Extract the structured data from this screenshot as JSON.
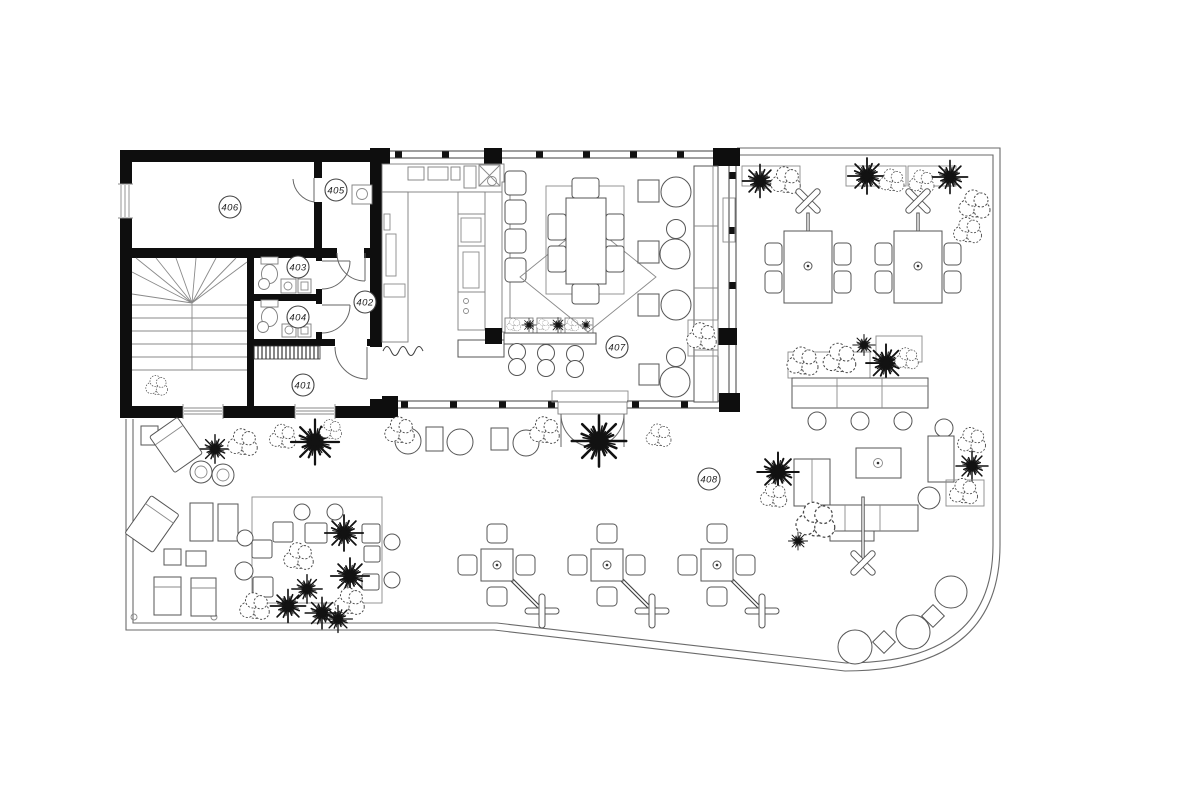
{
  "plan": {
    "type": "architectural floor plan with terrace",
    "colors": {
      "background": "#ffffff",
      "walls": "#0e0e0e",
      "lines": "#3f3f3f"
    },
    "rooms": [
      {
        "number": "401"
      },
      {
        "number": "402"
      },
      {
        "number": "403"
      },
      {
        "number": "404"
      },
      {
        "number": "405"
      },
      {
        "number": "406"
      },
      {
        "number": "407"
      },
      {
        "number": "408"
      }
    ],
    "icons": {
      "umbrella-x": "crossed bars",
      "cantilever-umbrella": "plus bars with diagonal pole",
      "plant-bush": "scribbled round bush",
      "plant-spiky": "starburst grass"
    }
  }
}
